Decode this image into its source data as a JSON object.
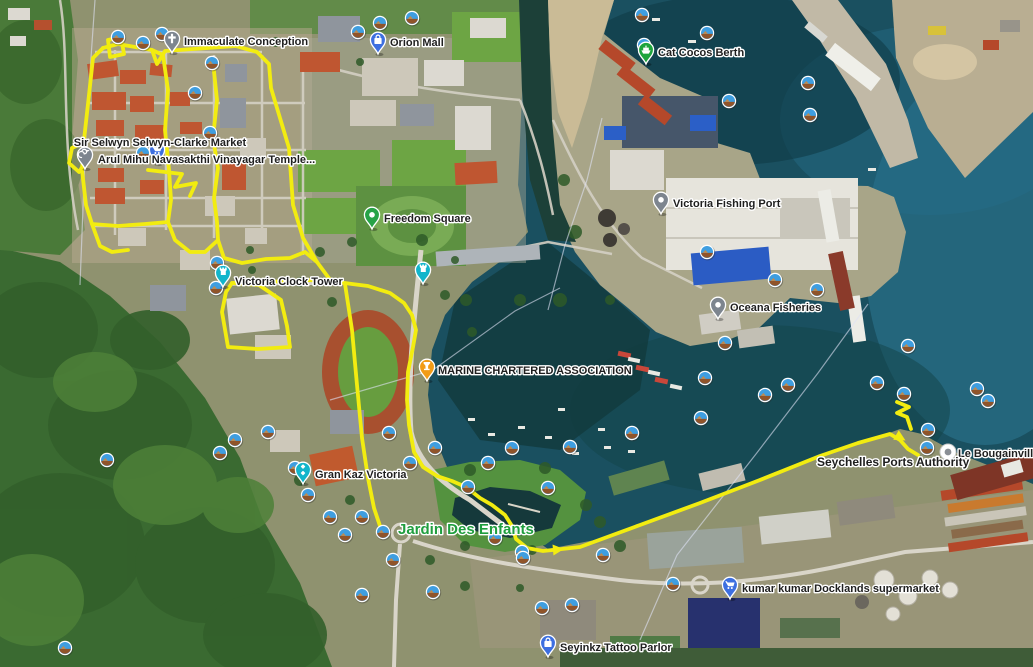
{
  "map": {
    "route": {
      "color": "#f2ec10",
      "paths": [
        "103,48 118,44 152,50 157,64 165,51 236,46 257,52 269,64 271,88 289,148 293,205 303,238 317,262 331,281",
        "103,48 93,58 89,95 84,140 82,170 86,205 92,224 118,226 145,224 168,222 171,200 169,170 165,130 168,90 163,55 152,50",
        "213,62 217,100 213,138 218,168 214,198 217,222 218,240",
        "218,240 224,258 242,263 266,259 290,258 305,252 317,262",
        "148,170 182,174 175,187 196,183 190,196",
        "108,40 121,37 124,54 110,57 108,40",
        "72,148 82,143 88,158 79,172 69,163 72,148",
        "92,224 100,246 112,252 128,250",
        "168,222 175,240 190,252 205,252 218,240",
        "232,283 226,292 222,312 228,347 258,349 290,347 287,326 281,300 259,285 232,283",
        "232,283 270,282 305,280 331,281",
        "331,281 352,284 368,286 390,293 404,303 412,315 416,330 413,347 408,372 407,400 409,425 414,452 423,467 437,476 452,481 466,487 480,498 492,505 505,515 512,526 516,539 527,548 543,551 562,549 580,547 640,525 700,503 760,480 820,456 858,443 890,434 900,440 908,449 918,455",
        "345,284 352,330 357,385 362,438 368,478 374,508 380,526 384,534",
        "897,402 909,407 897,413 907,417 911,429"
      ],
      "arrows": [
        {
          "x": 553,
          "y": 550,
          "deg": -5
        },
        {
          "x": 896,
          "y": 435,
          "deg": 30
        }
      ]
    },
    "cable_lines": [
      "95,0 86,130 80,285",
      "330,400 433,370 515,311 560,288",
      "868,304 818,373 756,454 677,555 640,640",
      "602,118 587,180 565,245 548,310"
    ],
    "pois": [
      {
        "id": "immaculate-conception",
        "label": "Immaculate Conception",
        "x": 172,
        "y": 40,
        "lx": 184,
        "ly": 45,
        "pin": "#7d858f",
        "icon": "cross"
      },
      {
        "id": "orion-mall",
        "label": "Orion Mall",
        "x": 378,
        "y": 41,
        "lx": 390,
        "ly": 46,
        "pin": "#3d6fe0",
        "icon": "bag"
      },
      {
        "id": "cat-cocos-berth",
        "label": "Cat Cocos Berth",
        "x": 646,
        "y": 51,
        "lx": 658,
        "ly": 56,
        "pin": "#1ea43c",
        "icon": "ferry"
      },
      {
        "id": "sir-selwyn-selwyn-clarke-market",
        "label": "Sir Selwyn Selwyn-Clarke Market",
        "x": 157,
        "y": 151,
        "lx": 160,
        "ly": 146,
        "anchor": "middle",
        "pin": "#3d6fe0",
        "icon": "cart"
      },
      {
        "id": "arul-mihu-navasakthi-vinayagar-temple",
        "label": "Arul Mihu Navasakthi Vinayagar Temple...",
        "x": 85,
        "y": 156,
        "lx": 98,
        "ly": 163,
        "pin": "#7d858f",
        "icon": "om"
      },
      {
        "id": "freedom-square",
        "label": "Freedom Square",
        "x": 372,
        "y": 216,
        "lx": 384,
        "ly": 222,
        "pin": "#27a347",
        "icon": "dot"
      },
      {
        "id": "victoria-fishing-port",
        "label": "Victoria Fishing Port",
        "x": 661,
        "y": 201,
        "lx": 673,
        "ly": 207,
        "pin": "#7d858f",
        "icon": "dot"
      },
      {
        "id": "victoria-clock-tower",
        "label": "Victoria Clock Tower",
        "x": 223,
        "y": 274,
        "lx": 235,
        "ly": 285,
        "pin": "#12b5cb",
        "icon": "tower"
      },
      {
        "id": "clock-tower-pin-2",
        "label": "",
        "x": 423,
        "y": 271,
        "lx": 0,
        "ly": 0,
        "pin": "#12b5cb",
        "icon": "tower"
      },
      {
        "id": "oceana-fisheries",
        "label": "Oceana Fisheries",
        "x": 718,
        "y": 306,
        "lx": 730,
        "ly": 311,
        "pin": "#7d858f",
        "icon": "dot"
      },
      {
        "id": "marine-chartered-association",
        "label": "MARINE CHARTERED ASSOCIATION",
        "x": 427,
        "y": 368,
        "lx": 438,
        "ly": 374,
        "pin": "#f29c17",
        "icon": "goblet"
      },
      {
        "id": "gran-kaz-victoria",
        "label": "Gran Kaz Victoria",
        "x": 303,
        "y": 471,
        "lx": 315,
        "ly": 478,
        "pin": "#12b5cb",
        "icon": "dice"
      },
      {
        "id": "kumar-kumar-docklands-supermarket",
        "label": "kumar kumar Docklands supermarket",
        "x": 730,
        "y": 586,
        "lx": 742,
        "ly": 592,
        "pin": "#3d6fe0",
        "icon": "cart"
      },
      {
        "id": "seyinkz-tattoo-parlor",
        "label": "Seyinkz Tattoo Parlor",
        "x": 548,
        "y": 644,
        "lx": 560,
        "ly": 651,
        "pin": "#3d6fe0",
        "icon": "bag"
      }
    ],
    "special_markers": [
      {
        "id": "le-bougainville",
        "label": "Le Bougainville",
        "x": 948,
        "y": 452,
        "lx": 958,
        "ly": 457
      }
    ],
    "area_labels": [
      {
        "id": "jardin-des-enfants",
        "label": "Jardin Des Enfants",
        "x": 398,
        "y": 534,
        "color": "#1f9e3e",
        "size": 15
      },
      {
        "id": "seychelles-ports-authority",
        "label": "Seychelles Ports Authority",
        "x": 817,
        "y": 466,
        "color": "#1e1e1e",
        "size": 12
      }
    ],
    "photo_markers": [
      [
        118,
        37
      ],
      [
        143,
        43
      ],
      [
        162,
        34
      ],
      [
        358,
        32
      ],
      [
        380,
        23
      ],
      [
        412,
        18
      ],
      [
        642,
        15
      ],
      [
        644,
        45
      ],
      [
        707,
        33
      ],
      [
        729,
        101
      ],
      [
        808,
        83
      ],
      [
        810,
        115
      ],
      [
        195,
        93
      ],
      [
        212,
        63
      ],
      [
        210,
        133
      ],
      [
        143,
        153
      ],
      [
        217,
        263
      ],
      [
        216,
        288
      ],
      [
        707,
        252
      ],
      [
        775,
        280
      ],
      [
        817,
        290
      ],
      [
        908,
        346
      ],
      [
        725,
        343
      ],
      [
        705,
        378
      ],
      [
        765,
        395
      ],
      [
        788,
        385
      ],
      [
        701,
        418
      ],
      [
        877,
        383
      ],
      [
        904,
        394
      ],
      [
        977,
        389
      ],
      [
        988,
        401
      ],
      [
        928,
        430
      ],
      [
        927,
        448
      ],
      [
        632,
        433
      ],
      [
        570,
        447
      ],
      [
        435,
        448
      ],
      [
        512,
        448
      ],
      [
        488,
        463
      ],
      [
        468,
        487
      ],
      [
        548,
        488
      ],
      [
        495,
        538
      ],
      [
        522,
        552
      ],
      [
        603,
        555
      ],
      [
        383,
        532
      ],
      [
        393,
        560
      ],
      [
        362,
        517
      ],
      [
        345,
        535
      ],
      [
        330,
        517
      ],
      [
        308,
        495
      ],
      [
        295,
        468
      ],
      [
        268,
        432
      ],
      [
        235,
        440
      ],
      [
        220,
        453
      ],
      [
        107,
        460
      ],
      [
        389,
        433
      ],
      [
        410,
        463
      ],
      [
        433,
        592
      ],
      [
        362,
        595
      ],
      [
        572,
        605
      ],
      [
        673,
        584
      ],
      [
        542,
        608
      ],
      [
        523,
        558
      ],
      [
        65,
        648
      ]
    ]
  }
}
